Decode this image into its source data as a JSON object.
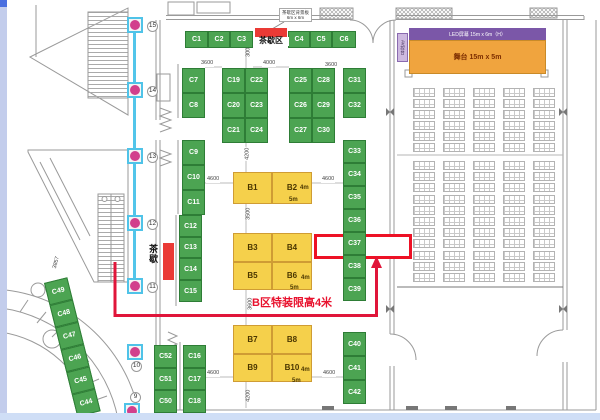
{
  "title": "展位平面图",
  "colors": {
    "booth_green": "#4ca452",
    "booth_green_border": "#2e7d36",
    "booth_yellow": "#f5d04b",
    "booth_yellow_border": "#cf9c34",
    "stage_orange": "#f0a43e",
    "led_purple": "#7b57a8",
    "av_purple": "#cdb9e0",
    "annotation_red": "#e8112d",
    "pillar_pink": "#d23f8c",
    "pillar_cyan": "#4fc3e8",
    "wall_gray": "#9a9a9a"
  },
  "stage": {
    "led_label": "LED屏幕 15m x 6m（H）",
    "label": "舞台 15m x 5m",
    "av_label": "AV控台"
  },
  "tea_break_top": {
    "label": "茶歇区",
    "note_line1": "茶歇区背景板",
    "note_line2": "6m x 6m"
  },
  "tea_break_side": {
    "label": "茶歇"
  },
  "annotation": {
    "height_limit": "B区特装限高4米",
    "highlighted_booth": "C37"
  },
  "booths": {
    "green": [
      {
        "l": "C1",
        "x": 185,
        "y": 31,
        "w": 23,
        "h": 17
      },
      {
        "l": "C2",
        "x": 208,
        "y": 31,
        "w": 22,
        "h": 17
      },
      {
        "l": "C3",
        "x": 230,
        "y": 31,
        "w": 23,
        "h": 17
      },
      {
        "l": "C4",
        "x": 288,
        "y": 31,
        "w": 22,
        "h": 17
      },
      {
        "l": "C5",
        "x": 310,
        "y": 31,
        "w": 22,
        "h": 17
      },
      {
        "l": "C6",
        "x": 332,
        "y": 31,
        "w": 24,
        "h": 17
      },
      {
        "l": "C7",
        "x": 182,
        "y": 68,
        "w": 23,
        "h": 25
      },
      {
        "l": "C8",
        "x": 182,
        "y": 93,
        "w": 23,
        "h": 25
      },
      {
        "l": "C19",
        "x": 222,
        "y": 68,
        "w": 23,
        "h": 25
      },
      {
        "l": "C22",
        "x": 245,
        "y": 68,
        "w": 23,
        "h": 25
      },
      {
        "l": "C20",
        "x": 222,
        "y": 93,
        "w": 23,
        "h": 25
      },
      {
        "l": "C23",
        "x": 245,
        "y": 93,
        "w": 23,
        "h": 25
      },
      {
        "l": "C21",
        "x": 222,
        "y": 118,
        "w": 23,
        "h": 25
      },
      {
        "l": "C24",
        "x": 245,
        "y": 118,
        "w": 23,
        "h": 25
      },
      {
        "l": "C25",
        "x": 289,
        "y": 68,
        "w": 23,
        "h": 25
      },
      {
        "l": "C28",
        "x": 312,
        "y": 68,
        "w": 23,
        "h": 25
      },
      {
        "l": "C26",
        "x": 289,
        "y": 93,
        "w": 23,
        "h": 25
      },
      {
        "l": "C29",
        "x": 312,
        "y": 93,
        "w": 23,
        "h": 25
      },
      {
        "l": "C27",
        "x": 289,
        "y": 118,
        "w": 23,
        "h": 25
      },
      {
        "l": "C30",
        "x": 312,
        "y": 118,
        "w": 23,
        "h": 25
      },
      {
        "l": "C31",
        "x": 343,
        "y": 68,
        "w": 23,
        "h": 25
      },
      {
        "l": "C32",
        "x": 343,
        "y": 93,
        "w": 23,
        "h": 25
      },
      {
        "l": "C9",
        "x": 182,
        "y": 140,
        "w": 23,
        "h": 25
      },
      {
        "l": "C10",
        "x": 182,
        "y": 165,
        "w": 23,
        "h": 25
      },
      {
        "l": "C11",
        "x": 182,
        "y": 190,
        "w": 23,
        "h": 25
      },
      {
        "l": "C12",
        "x": 179,
        "y": 215,
        "w": 23,
        "h": 22
      },
      {
        "l": "C13",
        "x": 179,
        "y": 237,
        "w": 23,
        "h": 21
      },
      {
        "l": "C14",
        "x": 179,
        "y": 258,
        "w": 23,
        "h": 22
      },
      {
        "l": "C15",
        "x": 179,
        "y": 280,
        "w": 23,
        "h": 22
      },
      {
        "l": "C33",
        "x": 343,
        "y": 140,
        "w": 23,
        "h": 23
      },
      {
        "l": "C34",
        "x": 343,
        "y": 163,
        "w": 23,
        "h": 23
      },
      {
        "l": "C35",
        "x": 343,
        "y": 186,
        "w": 23,
        "h": 23
      },
      {
        "l": "C36",
        "x": 343,
        "y": 209,
        "w": 23,
        "h": 23
      },
      {
        "l": "C37",
        "x": 343,
        "y": 232,
        "w": 23,
        "h": 23
      },
      {
        "l": "C38",
        "x": 343,
        "y": 255,
        "w": 23,
        "h": 23
      },
      {
        "l": "C39",
        "x": 343,
        "y": 278,
        "w": 23,
        "h": 23
      },
      {
        "l": "C40",
        "x": 343,
        "y": 332,
        "w": 23,
        "h": 24
      },
      {
        "l": "C41",
        "x": 343,
        "y": 356,
        "w": 23,
        "h": 24
      },
      {
        "l": "C42",
        "x": 343,
        "y": 380,
        "w": 23,
        "h": 24
      },
      {
        "l": "C16",
        "x": 183,
        "y": 345,
        "w": 23,
        "h": 23
      },
      {
        "l": "C17",
        "x": 183,
        "y": 368,
        "w": 23,
        "h": 22
      },
      {
        "l": "C18",
        "x": 183,
        "y": 390,
        "w": 23,
        "h": 23
      },
      {
        "l": "C52",
        "x": 154,
        "y": 345,
        "w": 23,
        "h": 23
      },
      {
        "l": "C51",
        "x": 154,
        "y": 368,
        "w": 23,
        "h": 22
      },
      {
        "l": "C50",
        "x": 154,
        "y": 390,
        "w": 23,
        "h": 23
      }
    ],
    "diagonal": {
      "x": 44,
      "y": 283,
      "w": 24,
      "cell_h": 23,
      "angle": -14,
      "labels": [
        "C49",
        "C48",
        "C47",
        "C46",
        "C45",
        "C44"
      ]
    },
    "yellow": [
      {
        "l": "B1",
        "x": 233,
        "y": 172,
        "w": 39,
        "h": 32
      },
      {
        "l": "B2",
        "x": 272,
        "y": 172,
        "w": 40,
        "h": 32
      },
      {
        "l": "B3",
        "x": 233,
        "y": 233,
        "w": 39,
        "h": 29
      },
      {
        "l": "B4",
        "x": 272,
        "y": 233,
        "w": 40,
        "h": 29
      },
      {
        "l": "B5",
        "x": 233,
        "y": 262,
        "w": 39,
        "h": 28
      },
      {
        "l": "B6",
        "x": 272,
        "y": 262,
        "w": 40,
        "h": 28
      },
      {
        "l": "B7",
        "x": 233,
        "y": 325,
        "w": 39,
        "h": 29
      },
      {
        "l": "B8",
        "x": 272,
        "y": 325,
        "w": 40,
        "h": 29
      },
      {
        "l": "B9",
        "x": 233,
        "y": 354,
        "w": 39,
        "h": 28
      },
      {
        "l": "B10",
        "x": 272,
        "y": 354,
        "w": 40,
        "h": 28
      }
    ],
    "size_labels": [
      {
        "t": "4m",
        "x": 300,
        "y": 185
      },
      {
        "t": "5m",
        "x": 289,
        "y": 197
      },
      {
        "t": "4m",
        "x": 301,
        "y": 275
      },
      {
        "t": "5m",
        "x": 290,
        "y": 285
      },
      {
        "t": "4m",
        "x": 301,
        "y": 367
      },
      {
        "t": "5m",
        "x": 292,
        "y": 378
      }
    ]
  },
  "dimensions": [
    {
      "t": "3600",
      "x": 200,
      "y": 61
    },
    {
      "t": "3000",
      "x": 242,
      "y": 48,
      "rot": -90
    },
    {
      "t": "4000",
      "x": 262,
      "y": 61
    },
    {
      "t": "3600",
      "x": 324,
      "y": 63
    },
    {
      "t": "4200",
      "x": 241,
      "y": 151,
      "rot": -90
    },
    {
      "t": "4600",
      "x": 206,
      "y": 177
    },
    {
      "t": "4600",
      "x": 321,
      "y": 177
    },
    {
      "t": "3500",
      "x": 242,
      "y": 211,
      "rot": -90
    },
    {
      "t": "3600",
      "x": 244,
      "y": 301,
      "rot": -90
    },
    {
      "t": "4600",
      "x": 206,
      "y": 371
    },
    {
      "t": "4600",
      "x": 322,
      "y": 371
    },
    {
      "t": "4200",
      "x": 242,
      "y": 393,
      "rot": -90
    },
    {
      "t": "3857",
      "x": 50,
      "y": 260,
      "rot": -75
    }
  ],
  "pillar_markers": [
    {
      "num": "15",
      "sq": [
        127,
        17
      ],
      "badge": [
        147,
        21
      ]
    },
    {
      "num": "14",
      "sq": [
        127,
        82
      ],
      "badge": [
        147,
        86
      ]
    },
    {
      "num": "13",
      "sq": [
        127,
        148
      ],
      "badge": [
        147,
        152
      ]
    },
    {
      "num": "12",
      "sq": [
        127,
        215
      ],
      "badge": [
        147,
        219
      ]
    },
    {
      "num": "11",
      "sq": [
        127,
        278
      ],
      "badge": [
        147,
        282
      ]
    },
    {
      "num": "10",
      "sq": [
        127,
        344
      ],
      "badge": [
        131,
        361
      ]
    },
    {
      "num": "9",
      "sq": [
        124,
        403
      ],
      "badge": [
        130,
        392
      ]
    }
  ],
  "seating": {
    "cols_x": [
      413,
      443,
      473,
      503,
      533
    ],
    "sections": [
      {
        "rows": 6,
        "start_y": 88,
        "row_step": 11
      },
      {
        "rows": 11,
        "start_y": 161,
        "row_step": 11.2
      }
    ]
  }
}
